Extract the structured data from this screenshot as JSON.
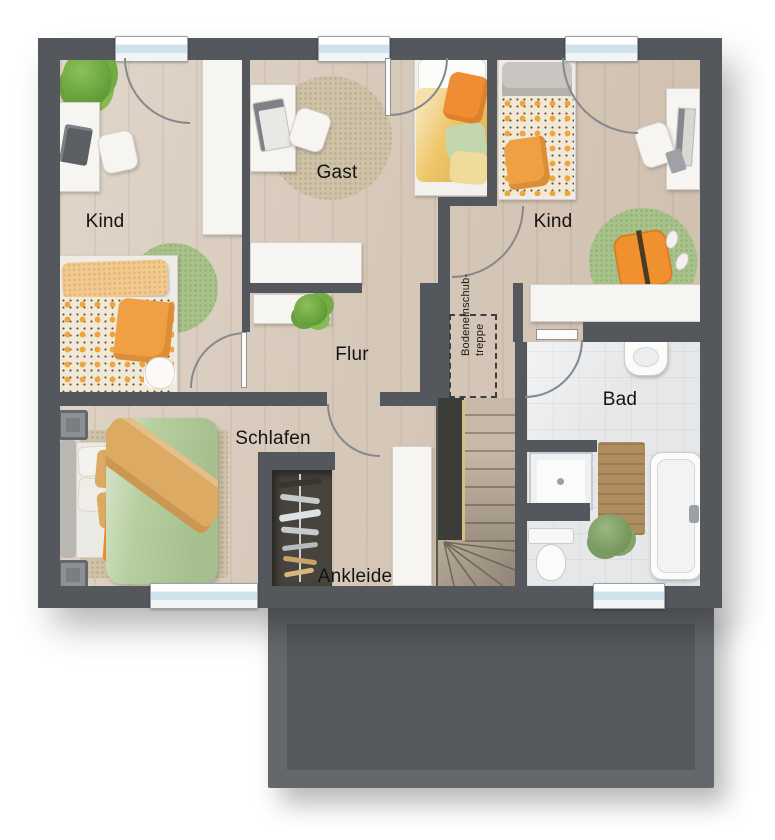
{
  "plan": {
    "rooms": [
      {
        "id": "kind-left",
        "label": "Kind"
      },
      {
        "id": "gast",
        "label": "Gast"
      },
      {
        "id": "kind-right",
        "label": "Kind"
      },
      {
        "id": "flur",
        "label": "Flur"
      },
      {
        "id": "schlafen",
        "label": "Schlafen"
      },
      {
        "id": "ankleide",
        "label": "Ankleide"
      },
      {
        "id": "bad",
        "label": "Bad"
      }
    ],
    "attic_hatch": {
      "line1": "Bodeneinschub-",
      "line2": "treppe"
    },
    "palette": {
      "wall": "#54575c",
      "wood_floor": "#d7c9ba",
      "tile_floor": "#e5e7e9",
      "garage_roof": "#56595d",
      "accent_orange": "#ef9f44",
      "accent_green": "#a7c389",
      "accent_yellow": "#eec668",
      "rug_beige": "#cfc2a6"
    }
  }
}
